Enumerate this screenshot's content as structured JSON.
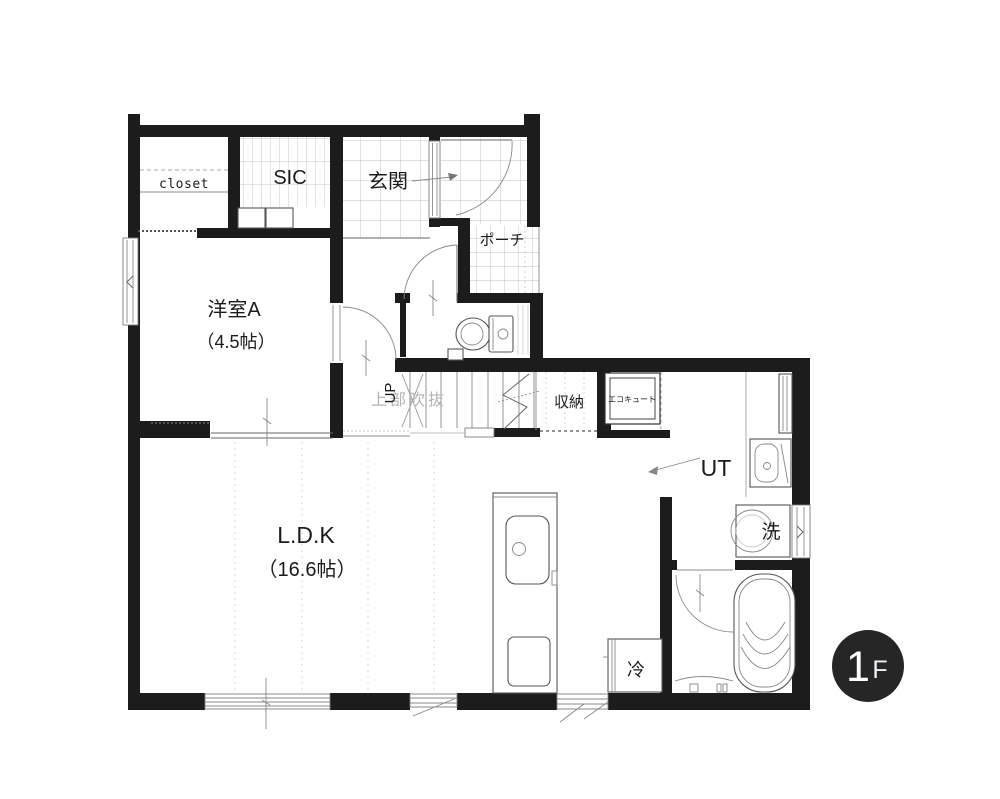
{
  "floor_plan": {
    "rooms": {
      "closet": "closet",
      "sic": "SIC",
      "entrance": "玄関",
      "porch": "ポーチ",
      "western_room_name": "洋室A",
      "western_room_size": "（4.5帖）",
      "ldk_name": "L.D.K",
      "ldk_size": "（16.6帖）",
      "utility": "UT",
      "storage": "収納",
      "washer": "洗",
      "fridge": "冷",
      "ecocute": "エコキュート",
      "stairs_up": "UP",
      "void_above": "上部吹抜"
    },
    "badge": {
      "number": "1",
      "suffix": "F"
    },
    "colors": {
      "wall": "#1c1c1c",
      "badge_bg": "#262626",
      "void_text": "#b5b5b5"
    }
  }
}
